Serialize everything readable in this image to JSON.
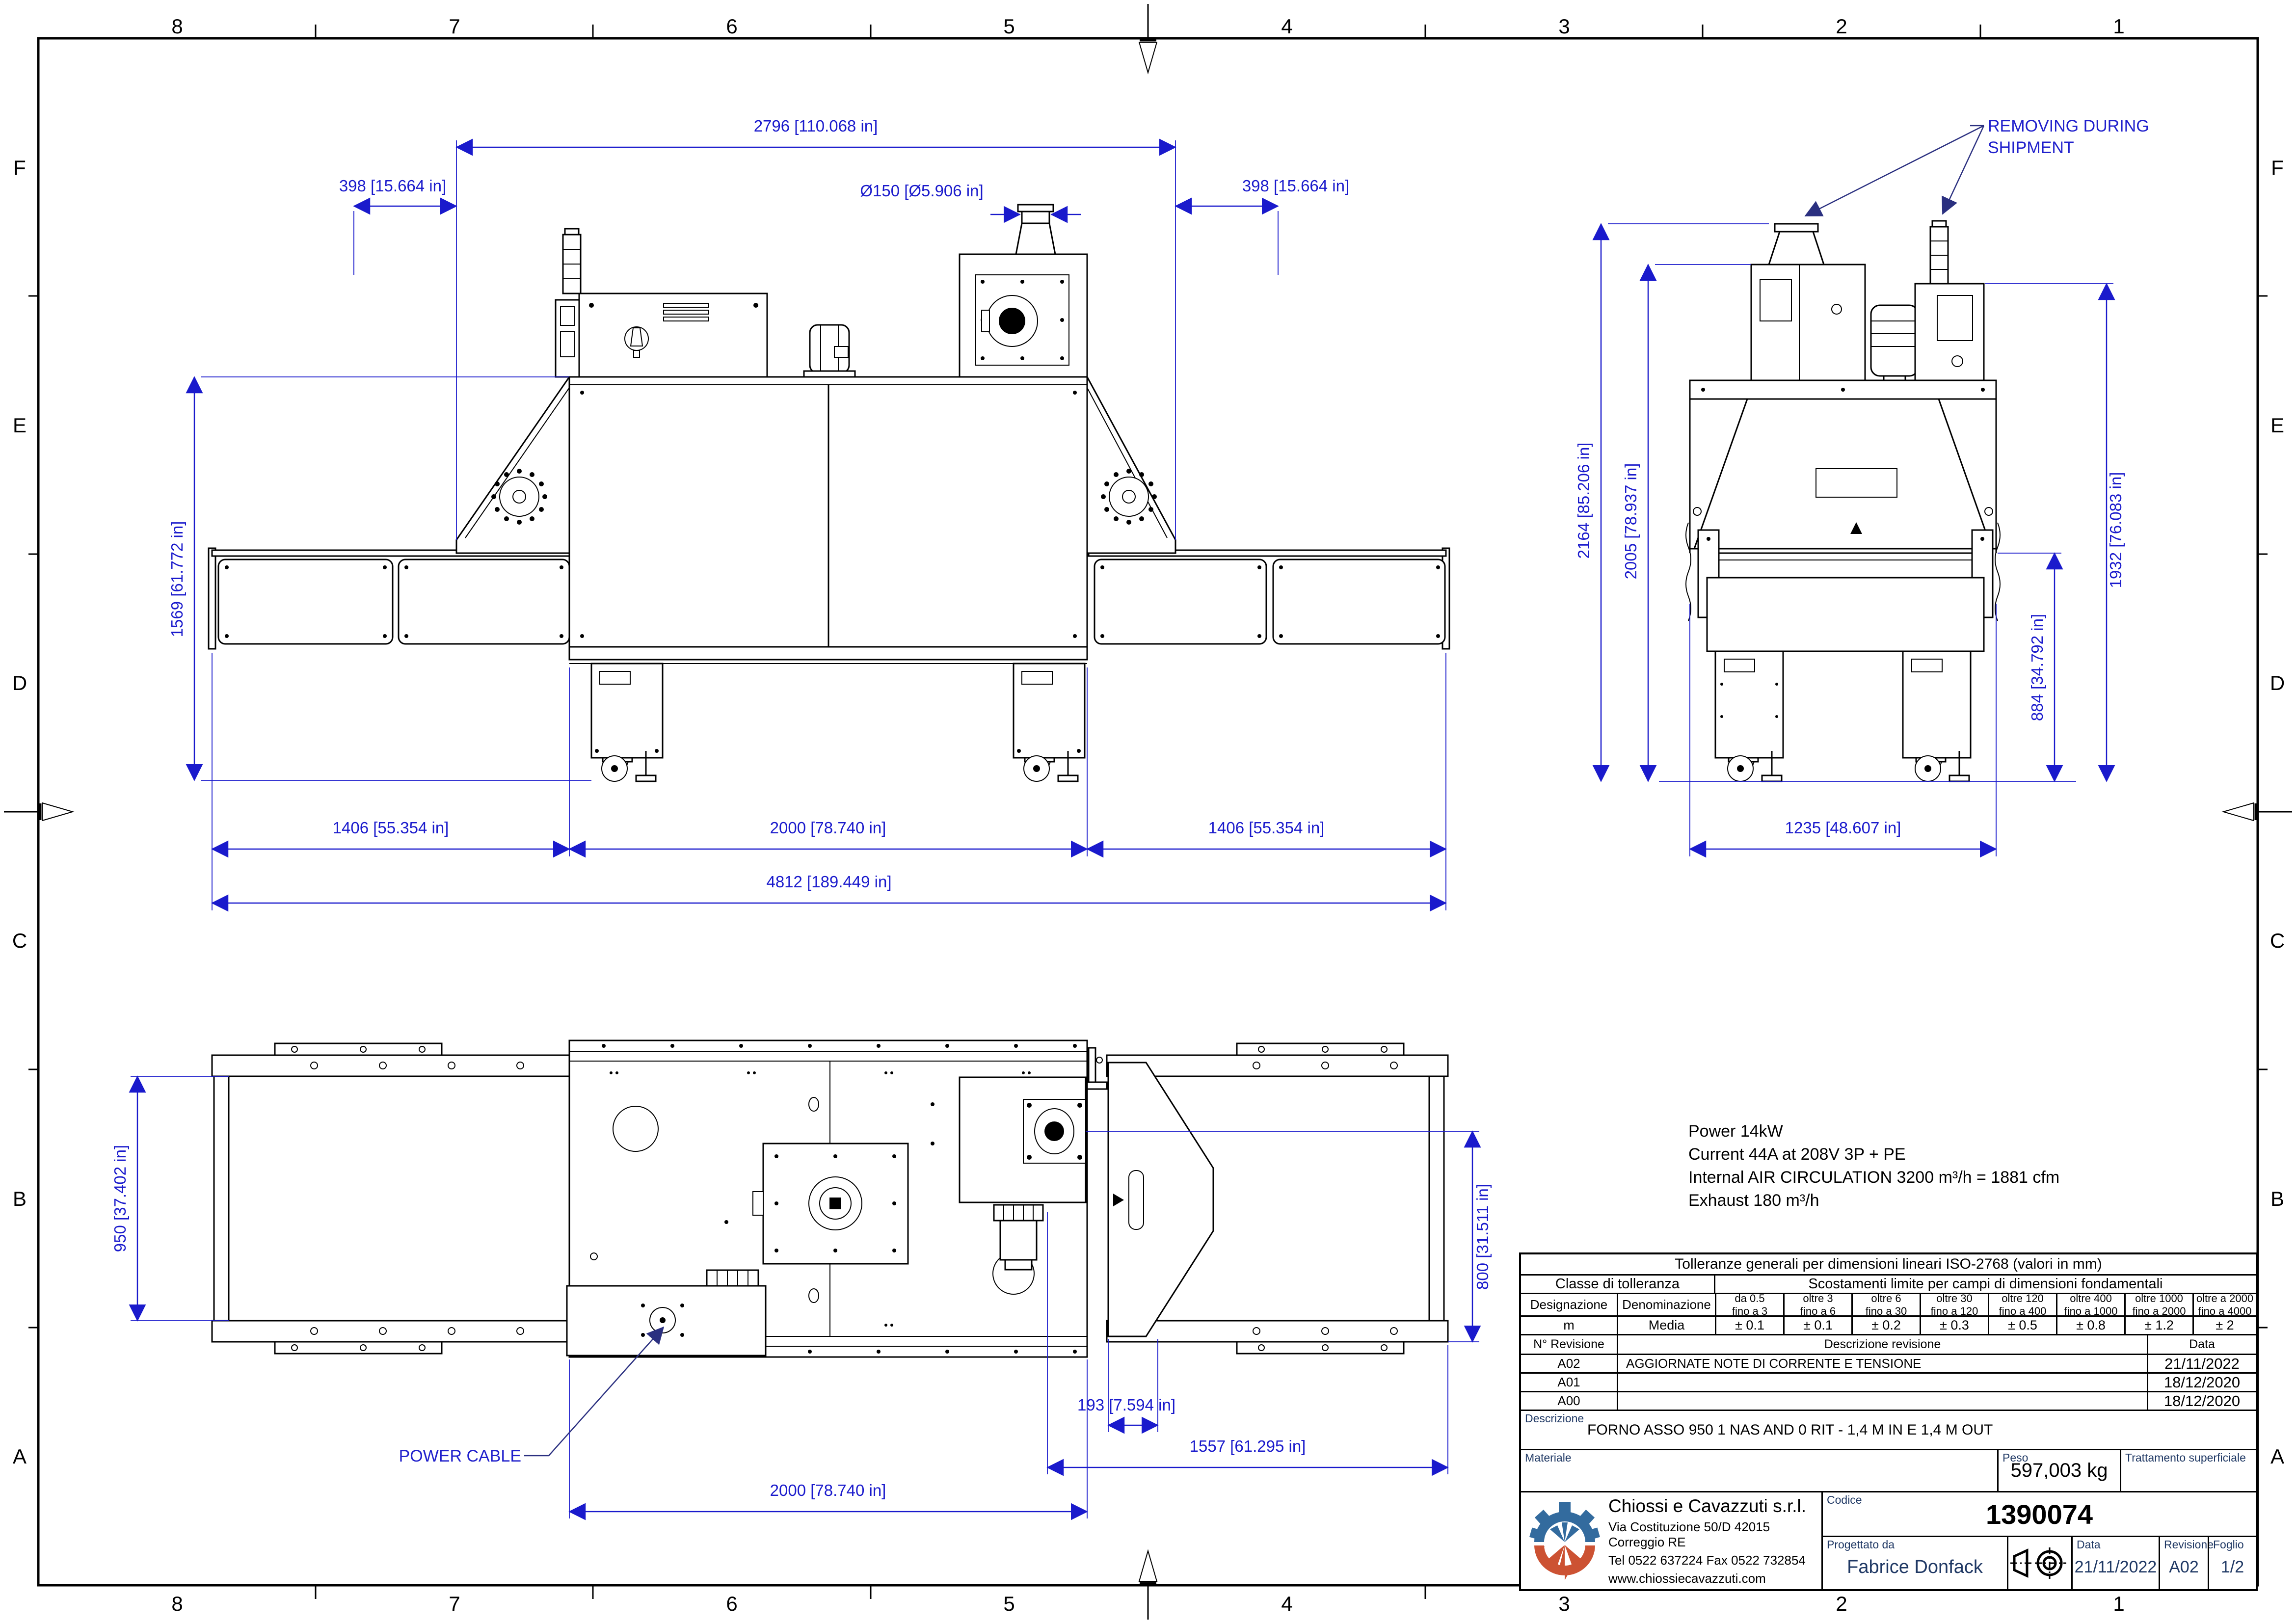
{
  "frame": {
    "cols": [
      "8",
      "7",
      "6",
      "5",
      "4",
      "3",
      "2",
      "1"
    ],
    "rows": [
      "F",
      "E",
      "D",
      "C",
      "B",
      "A"
    ]
  },
  "annotations": {
    "removing_line1": "REMOVING DURING",
    "removing_line2": "SHIPMENT",
    "power_cable": "POWER CABLE"
  },
  "dims": {
    "front_top_width": "2796 [110.068 in]",
    "front_left_offset": "398 [15.664 in]",
    "front_right_offset": "398 [15.664 in]",
    "exhaust_diameter": "Ø150 [Ø5.906 in]",
    "front_height": "1569 [61.772 in]",
    "front_left_conveyor": "1406 [55.354 in]",
    "front_oven_length": "2000 [78.740 in]",
    "front_right_conveyor": "1406 [55.354 in]",
    "front_total_length": "4812 [189.449 in]",
    "end_total_height": "2164 [85.206 in]",
    "end_box_height": "2005 [78.937 in]",
    "end_right_height": "1932 [76.083 in]",
    "end_belt_height": "884 [34.792 in]",
    "end_width": "1235 [48.607 in]",
    "plan_belt_width": "950 [37.402 in]",
    "plan_right_width": "800 [31.511 in]",
    "plan_offset": "193 [7.594 in]",
    "plan_right_length": "1557 [61.295 in]",
    "plan_oven_length": "2000 [78.740 in]"
  },
  "notes": {
    "line1": "Power 14kW",
    "line2": "Current 44A at 208V 3P + PE",
    "line3": "Internal AIR CIRCULATION 3200 m³/h = 1881 cfm",
    "line4": "Exhaust 180 m³/h"
  },
  "tolerance_table": {
    "title": "Tolleranze generali per dimensioni lineari ISO-2768 (valori in mm)",
    "class_header": "Classe di tolleranza",
    "limits_header": "Scostamenti limite per campi di dimensioni fondamentali",
    "col_designazione": "Designazione",
    "col_denominazione": "Denominazione",
    "ranges": [
      {
        "l1": "da 0.5",
        "l2": "fino a 3"
      },
      {
        "l1": "oltre 3",
        "l2": "fino a 6"
      },
      {
        "l1": "oltre 6",
        "l2": "fino a 30"
      },
      {
        "l1": "oltre 30",
        "l2": "fino a 120"
      },
      {
        "l1": "oltre 120",
        "l2": "fino a 400"
      },
      {
        "l1": "oltre 400",
        "l2": "fino a 1000"
      },
      {
        "l1": "oltre 1000",
        "l2": "fino a 2000"
      },
      {
        "l1": "oltre a 2000",
        "l2": "fino a 4000"
      }
    ],
    "row": {
      "designation": "m",
      "denomination": "Media",
      "values": [
        "± 0.1",
        "± 0.1",
        "± 0.2",
        "± 0.3",
        "± 0.5",
        "± 0.8",
        "± 1.2",
        "± 2"
      ]
    }
  },
  "revision_table": {
    "col_rev": "N° Revisione",
    "col_desc": "Descrizione revisione",
    "col_date": "Data",
    "rows": [
      {
        "rev": "A02",
        "desc": "AGGIORNATE NOTE DI CORRENTE E TENSIONE",
        "date": "21/11/2022"
      },
      {
        "rev": "A01",
        "desc": "",
        "date": "18/12/2020"
      },
      {
        "rev": "A00",
        "desc": "",
        "date": "18/12/2020"
      }
    ]
  },
  "title_block": {
    "descrizione_label": "Descrizione",
    "description": "FORNO ASSO 950 1 NAS AND 0 RIT - 1,4 M IN E 1,4 M OUT",
    "materiale_label": "Materiale",
    "peso_label": "Peso",
    "peso": "597,003 kg",
    "trattamento_label": "Trattamento superficiale",
    "company": "Chiossi e Cavazzuti s.r.l.",
    "address": "Via Costituzione 50/D 42015 Correggio RE",
    "phone": "Tel 0522 637224 Fax 0522 732854",
    "website": "www.chiossiecavazzuti.com",
    "codice_label": "Codice",
    "codice": "1390074",
    "progettato_label": "Progettato da",
    "designer": "Fabrice Donfack",
    "data_label": "Data",
    "date": "21/11/2022",
    "revisione_label": "Revisione",
    "revision": "A02",
    "foglio_label": "Foglio",
    "sheet": "1/2"
  },
  "colors": {
    "dimension_blue": "#1a1acc",
    "annotation_blue": "#2020cc",
    "leader_navy": "#2b3080",
    "label_navy": "#1f3864",
    "logo_blue": "#336b9e",
    "logo_red": "#cc5233"
  }
}
